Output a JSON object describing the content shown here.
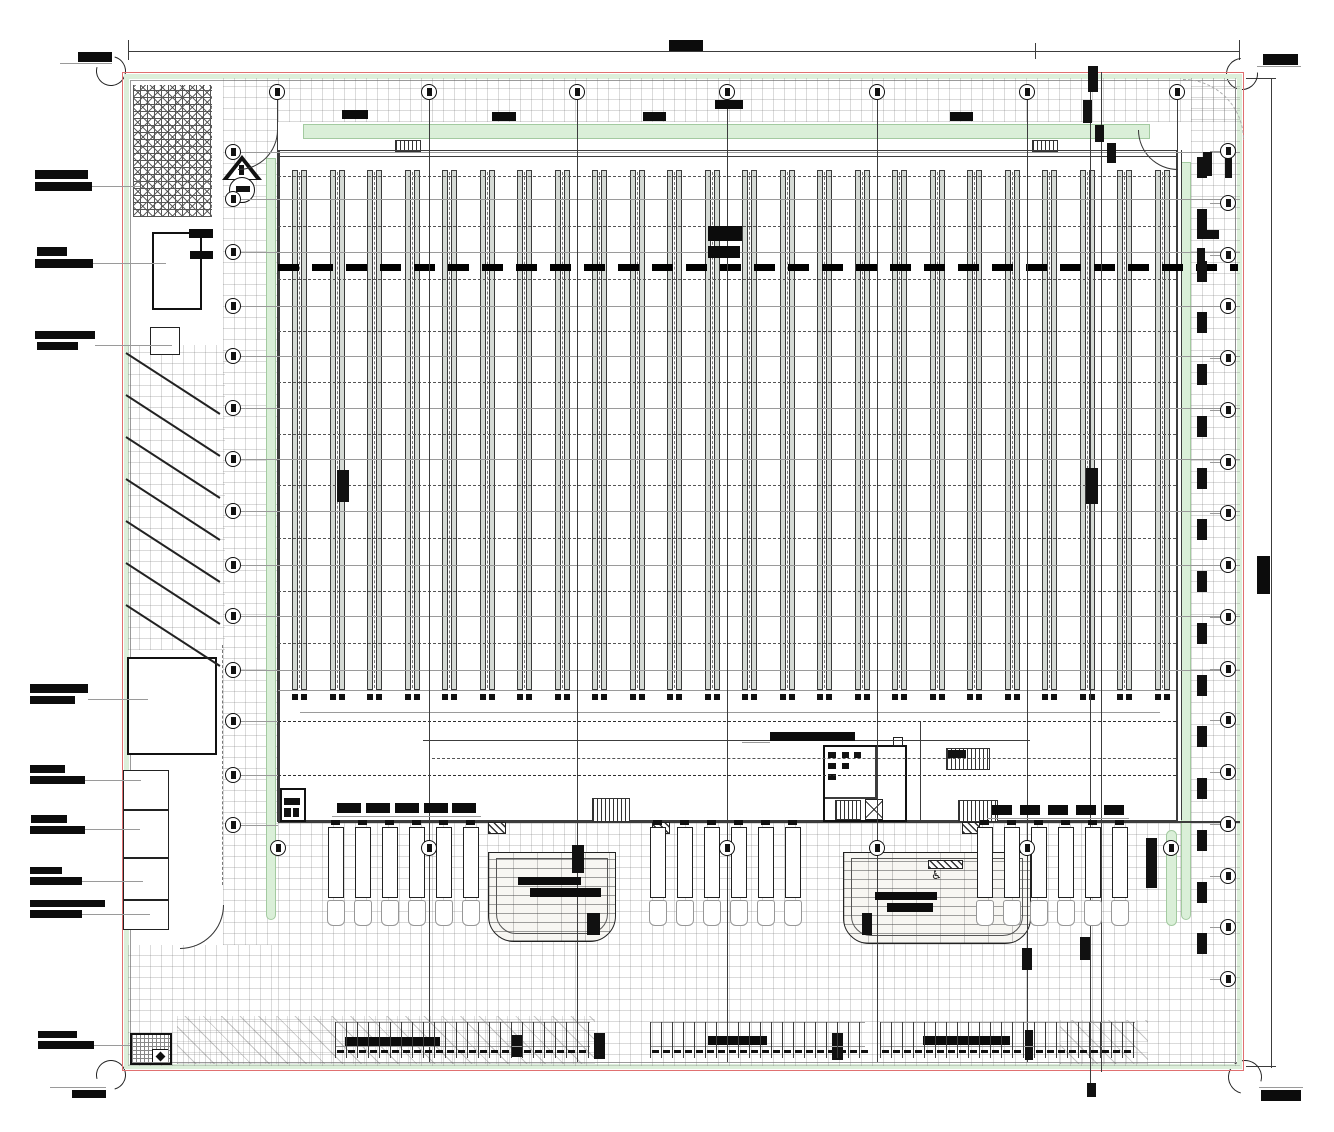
{
  "document": {
    "kind": "architectural-site-plan",
    "annotation_text_legible": false,
    "note": "All annotation and dimension text in the drawing is rendered too small to read; it appears as solid black redacted bars."
  },
  "colors": {
    "paper": "#ffffff",
    "property_line_red": "#e07070",
    "landscape_green": "#daefd8",
    "panel_gray": "#d5dad5",
    "line_black": "#111111",
    "hatch_gray": "#9a9a9a"
  },
  "geometry": {
    "canvas": {
      "w": 1334,
      "h": 1132
    },
    "boundary": {
      "x": 122,
      "y": 72,
      "w": 1122,
      "h": 999
    },
    "panels": {
      "count": 24,
      "x0": 292,
      "dx": 37.5,
      "y": 170,
      "h": 520,
      "barW": 6,
      "barGap": 3,
      "footY": 694
    },
    "grid": {
      "top_y": 92,
      "top_xs": [
        277,
        429,
        577,
        727,
        877,
        1027,
        1177
      ],
      "left_x": 233,
      "left_ys": [
        152,
        199,
        252,
        306,
        356,
        408,
        459,
        511,
        565,
        616,
        670,
        721,
        775,
        825
      ],
      "right_x": 1228,
      "right_y0": 151,
      "right_dy": 51.75,
      "right_n": 17,
      "mid_y": 848,
      "mid_xs": [
        278,
        429,
        727,
        877,
        1027,
        1171
      ],
      "tall_section_lines": [
        1090,
        1101
      ]
    },
    "trucks": {
      "group_x0": [
        328,
        650,
        977
      ],
      "per_group": 6,
      "dx": 27,
      "trailer_y": 827,
      "trailer_w": 16,
      "trailer_h": 71,
      "cab_y": 900,
      "cab_h": 26
    },
    "parking_row": {
      "top_y": 1022,
      "tick_h": 36,
      "tick_dx": 11,
      "groups": [
        [
          335,
          590
        ],
        [
          650,
          865
        ],
        [
          880,
          1135
        ]
      ]
    },
    "labels": [
      [
        78,
        52,
        34,
        10
      ],
      [
        35,
        170,
        53,
        9
      ],
      [
        35,
        182,
        57,
        9
      ],
      [
        37,
        247,
        30,
        9
      ],
      [
        35,
        259,
        58,
        9
      ],
      [
        35,
        331,
        60,
        8
      ],
      [
        37,
        342,
        41,
        8
      ],
      [
        30,
        684,
        58,
        9
      ],
      [
        30,
        696,
        45,
        8
      ],
      [
        30,
        765,
        35,
        8
      ],
      [
        30,
        776,
        55,
        8
      ],
      [
        31,
        815,
        36,
        8
      ],
      [
        30,
        826,
        55,
        8
      ],
      [
        30,
        867,
        32,
        7
      ],
      [
        30,
        877,
        52,
        8
      ],
      [
        30,
        900,
        75,
        7
      ],
      [
        30,
        910,
        52,
        8
      ],
      [
        38,
        1031,
        39,
        7
      ],
      [
        38,
        1041,
        56,
        8
      ],
      [
        72,
        1090,
        34,
        8
      ],
      [
        669,
        40,
        34,
        11
      ],
      [
        1263,
        54,
        35,
        11
      ],
      [
        1257,
        556,
        13,
        38
      ],
      [
        1261,
        1090,
        40,
        11
      ],
      [
        342,
        110,
        26,
        9
      ],
      [
        492,
        112,
        24,
        9
      ],
      [
        643,
        112,
        23,
        9
      ],
      [
        715,
        100,
        28,
        9
      ],
      [
        950,
        112,
        23,
        9
      ],
      [
        708,
        226,
        34,
        15
      ],
      [
        708,
        246,
        32,
        12
      ],
      [
        770,
        732,
        85,
        9
      ],
      [
        345,
        1037,
        95,
        10
      ],
      [
        708,
        1036,
        59,
        9
      ],
      [
        923,
        1036,
        87,
        9
      ],
      [
        518,
        877,
        63,
        8
      ],
      [
        530,
        888,
        71,
        9
      ],
      [
        875,
        892,
        62,
        8
      ],
      [
        887,
        903,
        46,
        9
      ],
      [
        189,
        229,
        24,
        9
      ],
      [
        190,
        251,
        23,
        8
      ]
    ],
    "dim_bars": {
      "rowA": {
        "y": 803,
        "w": 24,
        "h": 10,
        "xs": [
          337,
          366,
          395,
          424,
          452
        ]
      },
      "rowC": {
        "y": 805,
        "w": 20,
        "h": 10,
        "xs": [
          992,
          1020,
          1048,
          1076,
          1104
        ]
      }
    },
    "marks": [
      [
        337,
        470,
        12,
        32
      ],
      [
        1086,
        468,
        12,
        36
      ],
      [
        1088,
        66,
        10,
        26
      ],
      [
        1083,
        100,
        9,
        23
      ],
      [
        1095,
        125,
        9,
        17
      ],
      [
        1107,
        143,
        9,
        20
      ],
      [
        572,
        845,
        12,
        28
      ],
      [
        1080,
        937,
        10,
        23
      ],
      [
        1022,
        948,
        10,
        22
      ],
      [
        1087,
        1083,
        9,
        14
      ],
      [
        594,
        1033,
        11,
        26
      ],
      [
        832,
        1033,
        11,
        27
      ],
      [
        1025,
        1030,
        8,
        30
      ],
      [
        512,
        1035,
        10,
        22
      ],
      [
        587,
        913,
        13,
        22
      ],
      [
        862,
        913,
        10,
        22
      ],
      [
        1146,
        838,
        11,
        50
      ],
      [
        1203,
        152,
        9,
        24
      ],
      [
        1225,
        158,
        7,
        20
      ],
      [
        1197,
        230,
        22,
        9
      ],
      [
        1197,
        248,
        8,
        18
      ]
    ],
    "leaders": [
      [
        92,
        186,
        48
      ],
      [
        93,
        263,
        73
      ],
      [
        95,
        345,
        77
      ],
      [
        88,
        699,
        60
      ],
      [
        85,
        780,
        56
      ],
      [
        85,
        829,
        55
      ],
      [
        82,
        881,
        61
      ],
      [
        82,
        914,
        68
      ],
      [
        94,
        1045,
        36
      ],
      [
        60,
        63,
        52
      ],
      [
        50,
        1087,
        56
      ],
      [
        1257,
        66,
        44
      ],
      [
        1259,
        1087,
        44
      ],
      [
        742,
        742,
        28
      ]
    ],
    "stall_diagonals": {
      "x": 126,
      "y0": 352,
      "dy": 42,
      "n": 7,
      "len": 112,
      "angle_deg": 33
    }
  }
}
